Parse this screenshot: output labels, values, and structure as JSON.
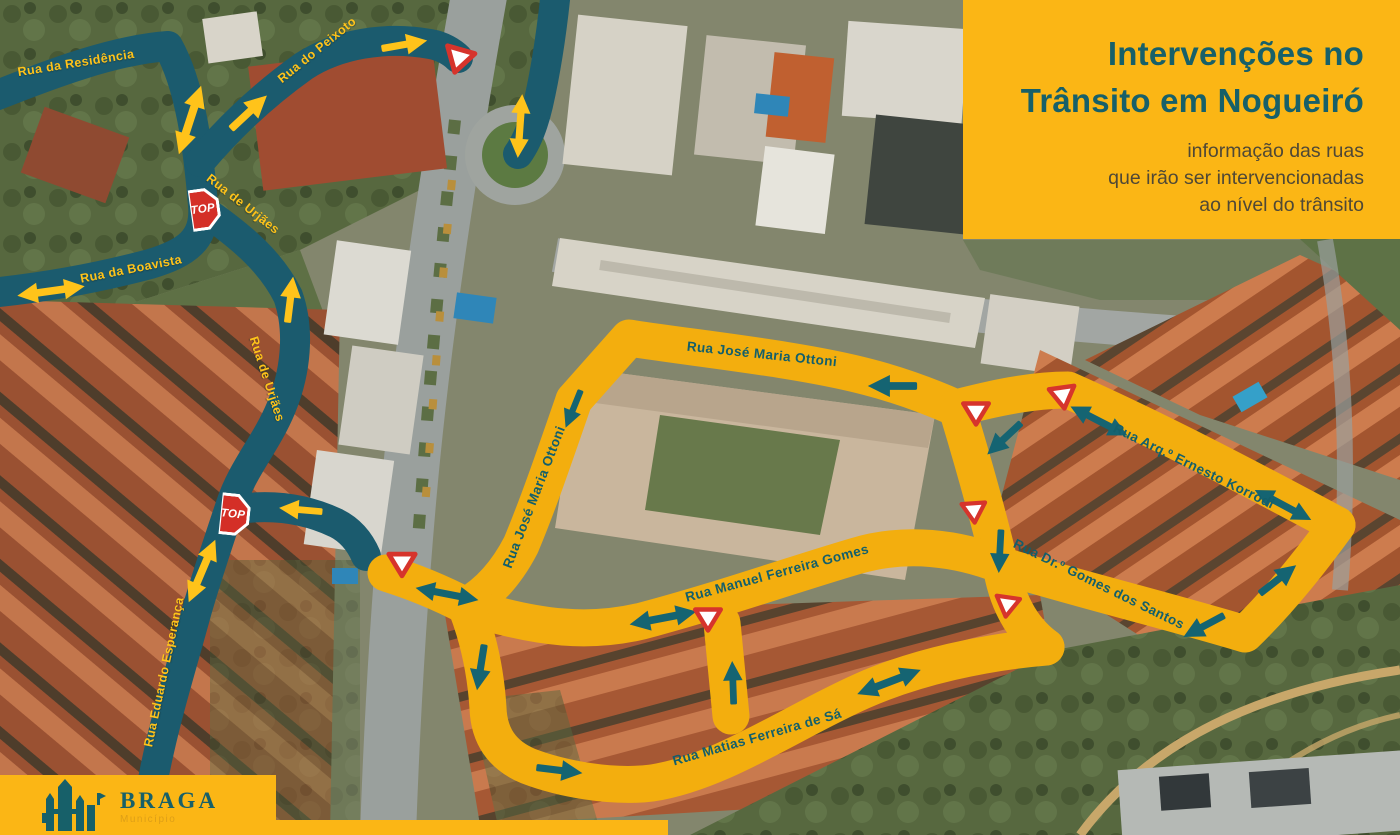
{
  "poster": {
    "title_box": {
      "title_lines": [
        "Intervenções no",
        "Trânsito em Nogueiró"
      ],
      "subtitle_lines": [
        "informação das ruas",
        "que irão ser intervencionadas",
        "ao nível do trânsito"
      ]
    },
    "logo": {
      "name": "BRAGA",
      "subtitle": "Município"
    },
    "signs": {
      "stop": "STOP"
    },
    "streets": {
      "teal_restricted": [
        {
          "name": "Rua da Residência"
        },
        {
          "name": "Rua do Peixoto"
        },
        {
          "name": "Rua de Urjães"
        },
        {
          "name": "Rua de Urjães"
        },
        {
          "name": "Rua da Boavista"
        },
        {
          "name": "Rua Eduardo Esperança"
        }
      ],
      "yellow_intervention": [
        {
          "name": "Rua José Maria Ottoni"
        },
        {
          "name": "Rua José Maria Ottoni"
        },
        {
          "name": "Rua Manuel Ferreira Gomes"
        },
        {
          "name": "Rua Arq.º Ernesto Korrodi"
        },
        {
          "name": "Rua Dr.º Gomes dos Santos"
        },
        {
          "name": "Rua Matias Ferreira de Sá"
        }
      ]
    },
    "colors": {
      "teal_band": "#1b5b6e",
      "yellow_band": "#f3ae0e",
      "panel_yellow": "#fbb615",
      "title_teal": "#176069",
      "subtitle_brown": "#4f4836",
      "arrow_yellow": "#ffc31a",
      "arrow_teal": "#156472",
      "sign_red": "#d42f27"
    }
  }
}
